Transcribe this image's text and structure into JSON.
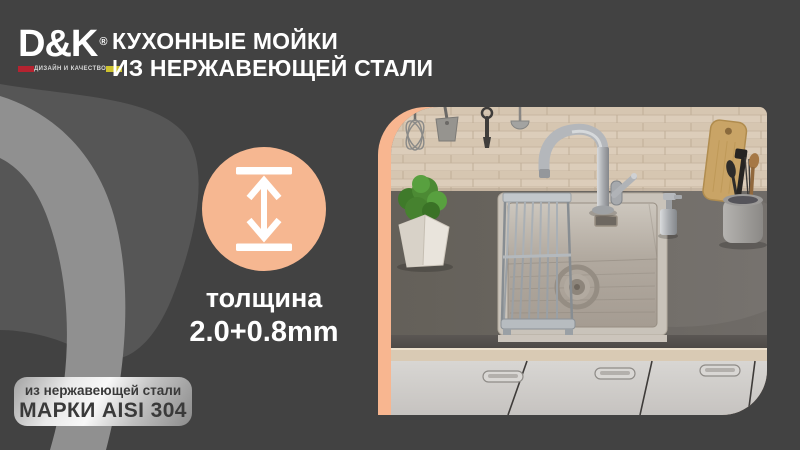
{
  "brand": {
    "logo_text": "D&K",
    "registered_mark": "®",
    "tagline": "ДИЗАЙН И КАЧЕСТВО"
  },
  "header": {
    "title_line1": "КУХОННЫЕ МОЙКИ",
    "title_line2": "ИЗ НЕРЖАВЕЮЩЕЙ СТАЛИ"
  },
  "feature": {
    "icon": "thickness-double-arrow-icon",
    "label": "толщина",
    "value": "2.0+0.8mm"
  },
  "badge": {
    "line1": "из нержавеющей стали",
    "line2": "МАРКИ AISI 304"
  },
  "colors": {
    "background": "#424242",
    "accent_peach": "#f8b690",
    "swirl_light": "#909090",
    "swirl_mid": "#565656",
    "logo_red": "#b52330",
    "logo_yellow": "#cdc22e",
    "badge_text": "#3a3a3a",
    "text_white": "#ffffff"
  },
  "photo": {
    "subject": "stainless-steel-kitchen-sink-scene"
  }
}
